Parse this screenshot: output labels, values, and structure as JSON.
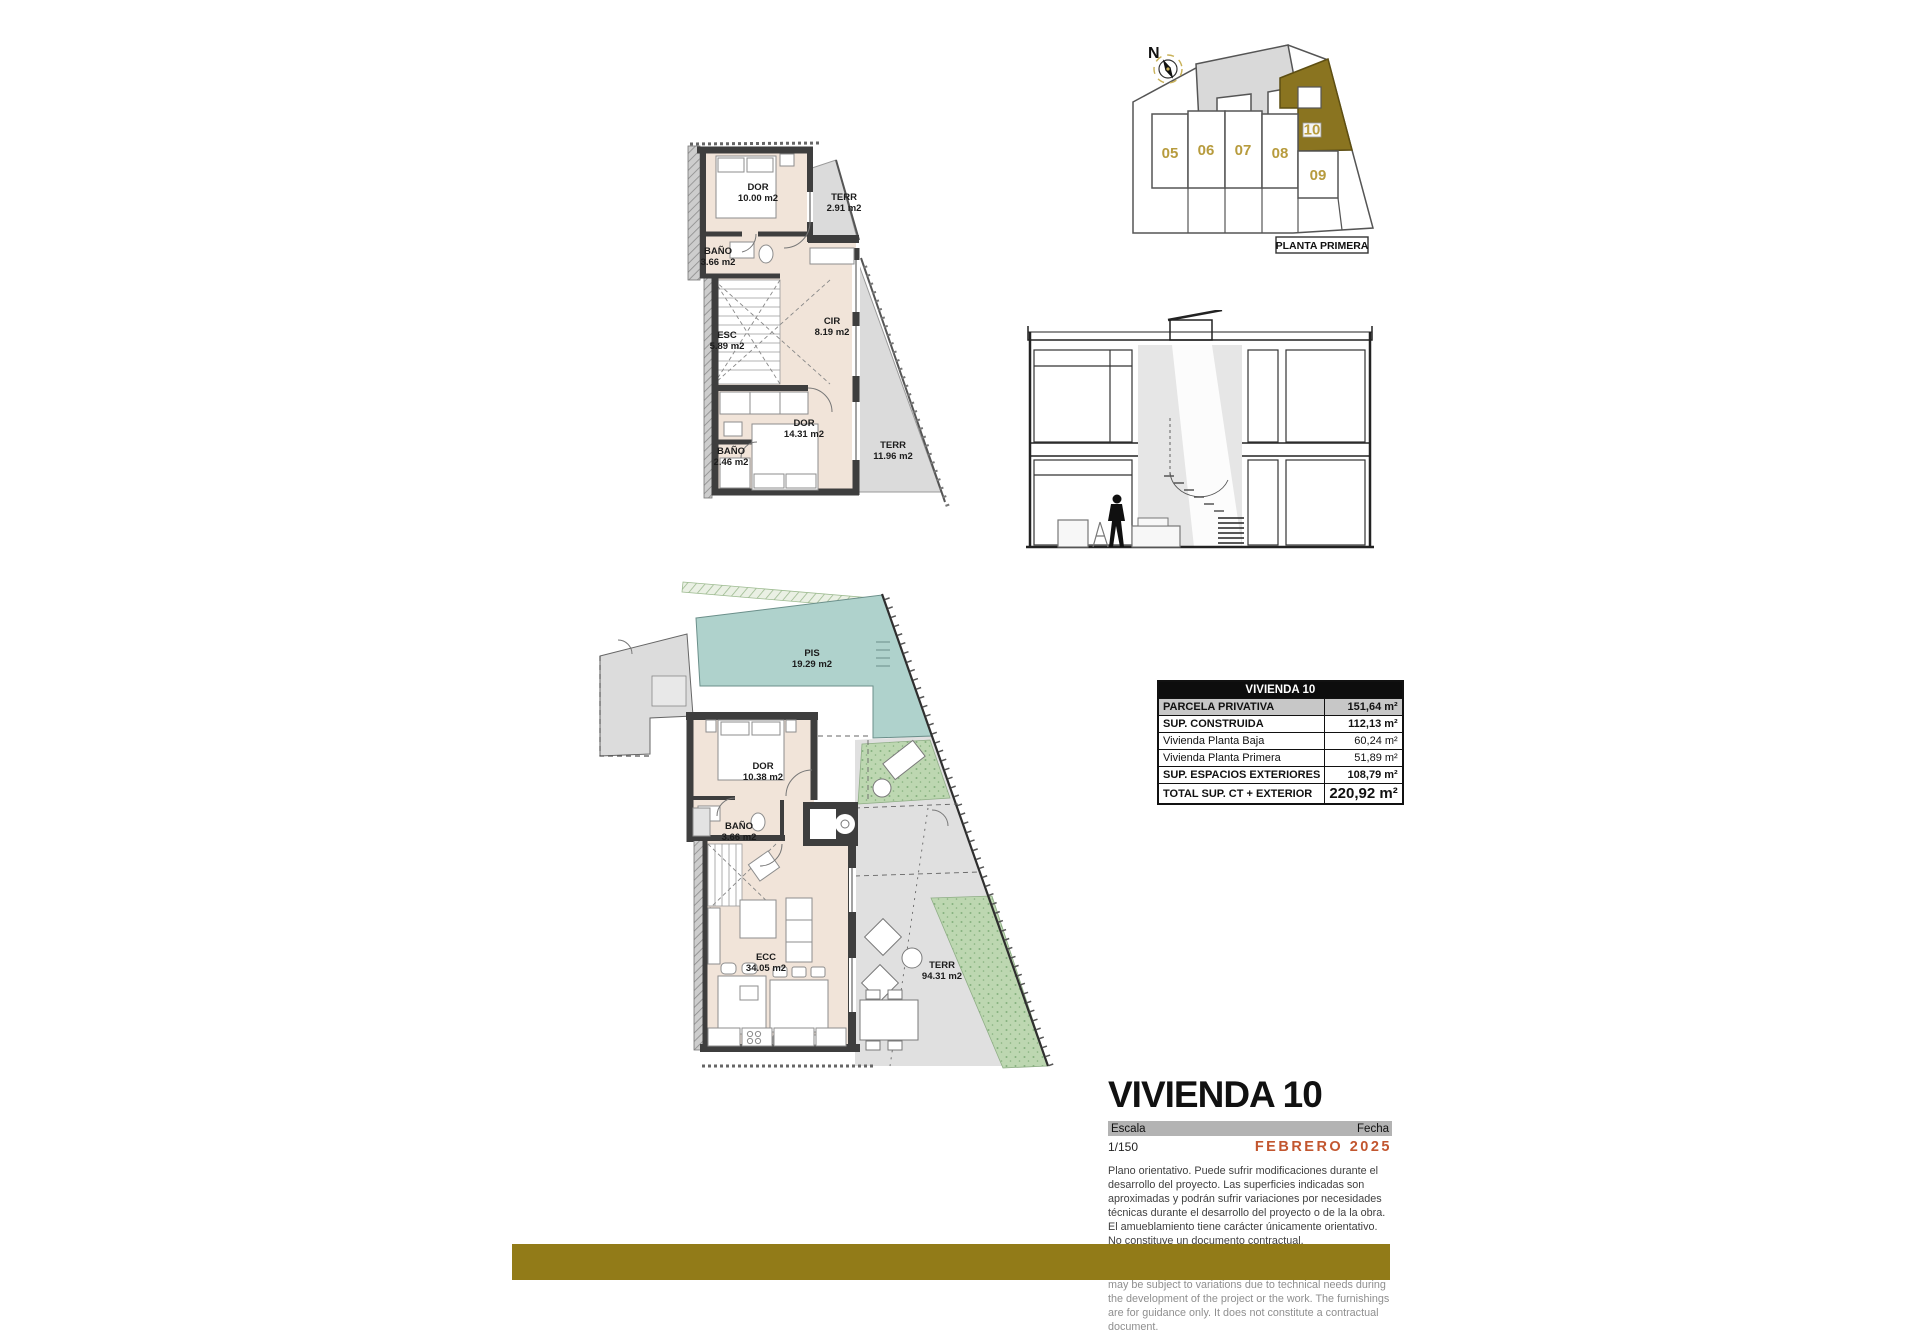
{
  "site_plan": {
    "compass_label": "N",
    "unit_labels": [
      "05",
      "06",
      "07",
      "08",
      "09"
    ],
    "highlight_unit": "10",
    "caption": "PLANTA PRIMERA"
  },
  "first_floor": {
    "rooms": [
      {
        "name": "DOR",
        "area": "10.00 m2"
      },
      {
        "name": "TERR",
        "area": "2.91 m2"
      },
      {
        "name": "BAÑO",
        "area": "3.66 m2"
      },
      {
        "name": "ESC",
        "area": "5.89 m2"
      },
      {
        "name": "CIR",
        "area": "8.19 m2"
      },
      {
        "name": "DOR",
        "area": "14.31 m2"
      },
      {
        "name": "BAÑO",
        "area": "2.46 m2"
      },
      {
        "name": "TERR",
        "area": "11.96 m2"
      }
    ]
  },
  "ground_floor": {
    "rooms": [
      {
        "name": "PIS",
        "area": "19.29 m2"
      },
      {
        "name": "DOR",
        "area": "10.38 m2"
      },
      {
        "name": "BAÑO",
        "area": "3.66 m2"
      },
      {
        "name": "ECC",
        "area": "34.05 m2"
      },
      {
        "name": "TERR",
        "area": "94.31 m2"
      }
    ]
  },
  "area_table": {
    "title": "VIVIENDA 10",
    "rows": [
      {
        "label": "PARCELA PRIVATIVA",
        "value": "151,64 m²"
      },
      {
        "label": "SUP. CONSTRUIDA",
        "value": "112,13 m²"
      },
      {
        "label": "Vivienda Planta Baja",
        "value": "60,24 m²"
      },
      {
        "label": "Vivienda Planta Primera",
        "value": "51,89 m²"
      },
      {
        "label": "SUP. ESPACIOS EXTERIORES",
        "value": "108,79 m²"
      },
      {
        "label": "TOTAL SUP. CT + EXTERIOR",
        "value": "220,92 m²"
      }
    ]
  },
  "title_block": {
    "title": "VIVIENDA 10",
    "scale_label": "Escala",
    "scale_value": "1/150",
    "date_label": "Fecha",
    "date_value": "FEBRERO 2025",
    "date_color": "#C2562F",
    "disclaimer_es": "Plano orientativo. Puede sufrir modificaciones durante el desarrollo del proyecto. Las superficies indicadas son aproximadas y podrán sufrir variaciones por necesidades técnicas durante el desarrollo del proyecto o de la la obra. El amueblamiento tiene carácter únicamente orientativo. No constituye un documento contractual.",
    "disclaimer_en": "Indicative plan. It may be modified during the development of the project. The areas indicated are approximate and may be subject to variations due to technical needs during the development of the project or the work. The furnishings are for guidance only. It does not constitute a contractual document."
  }
}
